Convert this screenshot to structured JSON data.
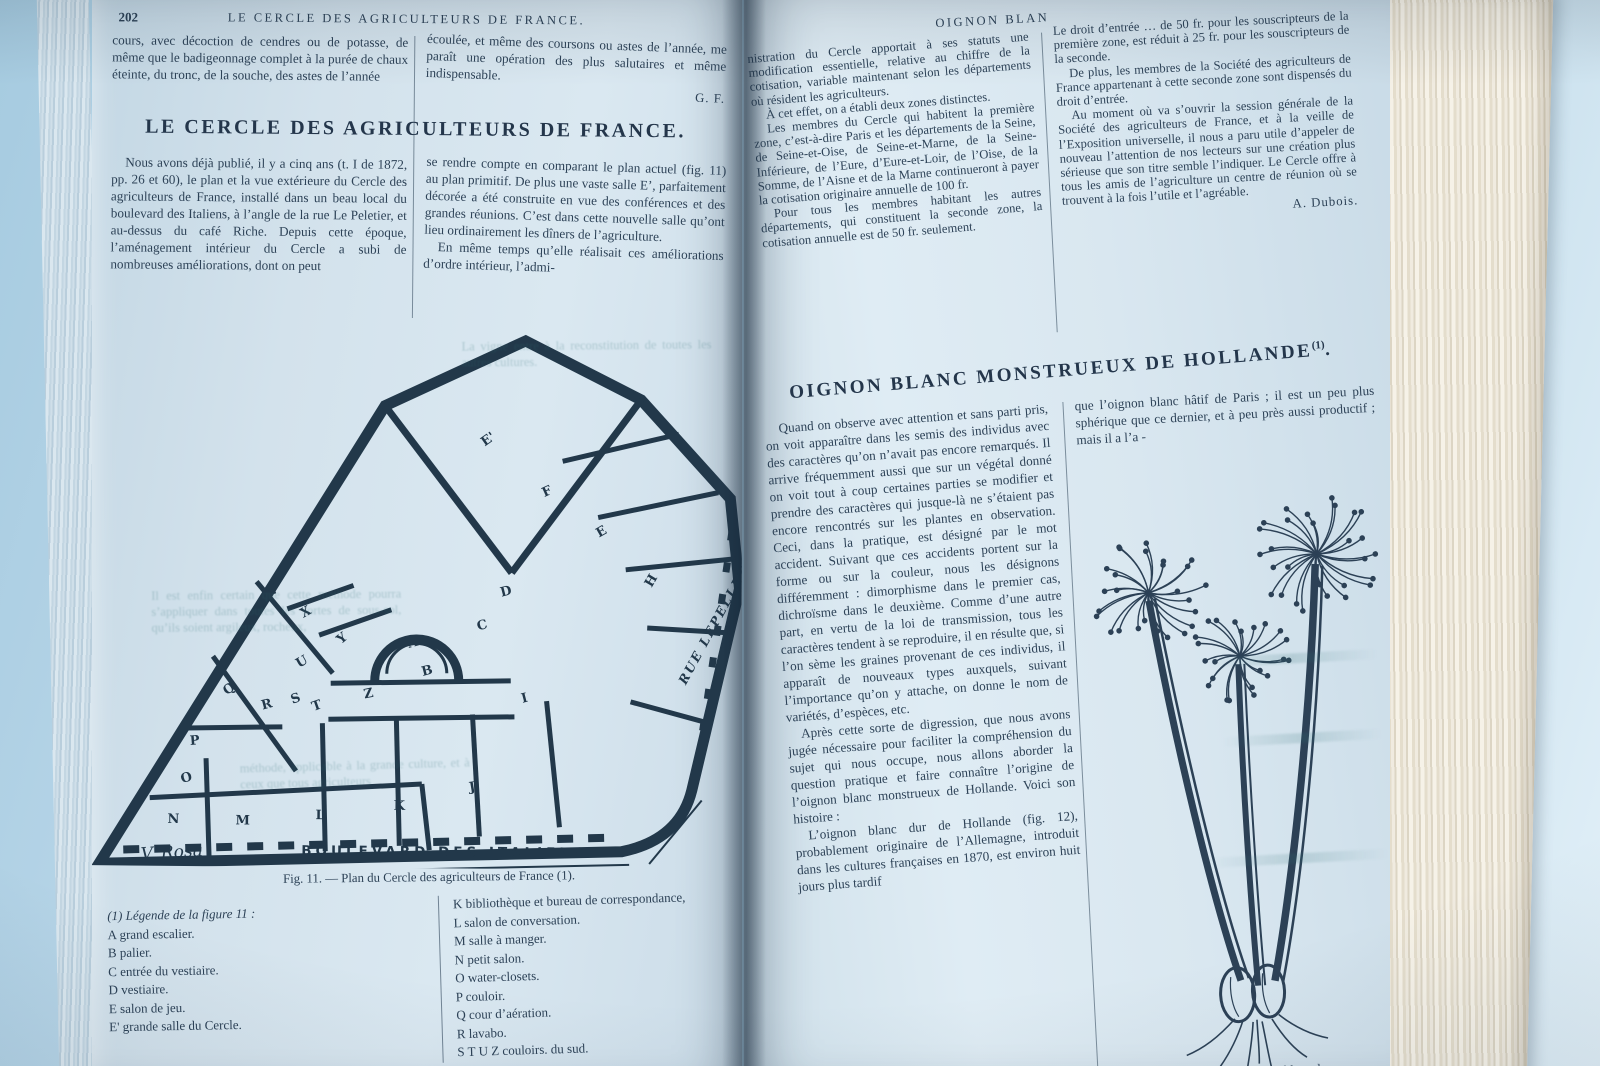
{
  "left_page": {
    "page_number": "202",
    "running_header": "LE CERCLE DES AGRICULTEURS DE FRANCE.",
    "top_col1": "cours, avec décoction de cendres ou de potasse, de même que le badigeonnage complet à la purée de chaux éteinte, du tronc, de la souche, des astes de l’année",
    "top_col2": "écoulée, et même des coursons ou astes de l’année, me paraît une opération des plus salutaires et même indispensable.",
    "top_col2_signature": "G. F.",
    "article_title": "LE CERCLE DES AGRICULTEURS DE FRANCE.",
    "body_col1": "Nous avons déjà publié, il y a cinq ans (t. I de 1872, pp. 26 et 60), le plan et la vue extérieure du Cercle des agriculteurs de France, installé dans un beau local du boulevard des Italiens, à l’angle de la rue Le Peletier, et au-dessus du café Riche. Depuis cette époque, l’aménagement intérieur du Cercle a subi de nombreuses améliorations, dont on peut",
    "body_col2_p1": "se rendre compte en comparant le plan actuel (fig. 11) au plan primitif. De plus une vaste salle E’, parfaitement décorée a été construite en vue des conférences et des grandes réunions. C’est dans cette nouvelle salle qu’ont lieu ordinairement les dîners de l’agriculture.",
    "body_col2_p2": "En même temps qu’elle réalisait ces améliorations d’ordre intérieur, l’admi-",
    "ghost": [
      "La vigne entre à la reconstitution de toutes les autres cultures.",
      "Il est enfin certain que cette méthode pourra s’appliquer dans toutes les sortes de sous-sol, qu’ils soient argileux, rocheux,",
      "méthode, applicable à la grande culture, et à ceux que tous agriculteurs"
    ],
    "figure": {
      "caption": "Fig. 11. — Plan du Cercle des agriculteurs de France (1).",
      "signature": "V. Rosa",
      "street_bottom": "BOULEVARD DES ITALIENS",
      "street_right": "RUE LEPELLETIER",
      "rooms": [
        {
          "t": "E'",
          "x": 392,
          "y": 118,
          "r": -36
        },
        {
          "t": "F",
          "x": 452,
          "y": 168,
          "r": -25
        },
        {
          "t": "E",
          "x": 507,
          "y": 208,
          "r": -30
        },
        {
          "t": "D",
          "x": 410,
          "y": 268,
          "r": -15
        },
        {
          "t": "C",
          "x": 387,
          "y": 302,
          "r": -15
        },
        {
          "t": "A",
          "x": 318,
          "y": 320,
          "r": -15
        },
        {
          "t": "B",
          "x": 332,
          "y": 348,
          "r": -15
        },
        {
          "t": "H",
          "x": 560,
          "y": 258,
          "r": -60
        },
        {
          "t": "I",
          "x": 432,
          "y": 374,
          "r": -15
        },
        {
          "t": "Z",
          "x": 274,
          "y": 371,
          "r": -12
        },
        {
          "t": "Y",
          "x": 250,
          "y": 317,
          "r": -40
        },
        {
          "t": "X",
          "x": 212,
          "y": 291,
          "r": -30
        },
        {
          "t": "V",
          "x": 180,
          "y": 270,
          "r": -40
        },
        {
          "t": "U",
          "x": 208,
          "y": 341,
          "r": -30
        },
        {
          "t": "S",
          "x": 202,
          "y": 377,
          "r": -20
        },
        {
          "t": "T",
          "x": 223,
          "y": 384,
          "r": -20
        },
        {
          "t": "R",
          "x": 172,
          "y": 383,
          "r": -15
        },
        {
          "t": "Q",
          "x": 136,
          "y": 369,
          "r": -35
        },
        {
          "t": "P",
          "x": 100,
          "y": 419,
          "r": -5
        },
        {
          "t": "O",
          "x": 92,
          "y": 457,
          "r": -15
        },
        {
          "t": "N",
          "x": 78,
          "y": 497,
          "r": 0
        },
        {
          "t": "M",
          "x": 146,
          "y": 498,
          "r": 0
        },
        {
          "t": "L",
          "x": 226,
          "y": 492,
          "r": 0
        },
        {
          "t": "K",
          "x": 304,
          "y": 482,
          "r": 0
        },
        {
          "t": "J",
          "x": 380,
          "y": 463,
          "r": -10
        }
      ]
    },
    "legend_left_title": "(1) Légende de la figure 11 :",
    "legend_left": [
      "A  grand escalier.",
      "B  palier.",
      "C  entrée du vestiaire.",
      "D  vestiaire.",
      "E  salon de jeu.",
      "E'  grande salle du Cercle."
    ],
    "legend_right": [
      "K  bibliothèque et bureau de correspondance,",
      "L  salon de conversation.",
      "M  salle à manger.",
      "N  petit salon.",
      "O  water-closets.",
      "P  couloir.",
      "Q  cour d’aération.",
      "R  lavabo.",
      "S T U Z  couloirs.        du sud."
    ]
  },
  "right_page": {
    "running_header": "OIGNON BLAN",
    "top_col1_p1": "nistration du Cercle apportait à ses statuts une modification essentielle, relative au chiffre de la cotisation, variable maintenant selon les départements où résident les agriculteurs.",
    "top_col1_p2": "À cet effet, on a établi deux zones distinctes.",
    "top_col1_p3": "Les membres du Cercle qui habitent la première zone, c’est-à-dire Paris et les départements de la Seine, de Seine-et-Oise, de Seine-et-Marne, de la Seine-Inférieure, de l’Eure, d’Eure-et-Loir, de l’Oise, de la Somme, de l’Aisne et de la Marne continueront à payer la cotisation originaire annuelle de 100 fr.",
    "top_col1_p4": "Pour tous les membres habitant les autres départements, qui constituent la seconde zone, la cotisation annuelle est de 50 fr. seulement.",
    "top_col2_p1": "Le droit d’entrée … de 50 fr. pour les souscripteurs de la première zone, est réduit à 25 fr. pour les souscripteurs de la seconde.",
    "top_col2_p2": "De plus, les membres de la Société des agriculteurs de France appartenant à cette seconde zone sont dispensés du droit d’entrée.",
    "top_col2_p3": "Au moment où va s’ouvrir la session générale de la Société des agriculteurs de France, et à la veille de l’Exposition universelle, il nous a paru utile d’appeler de nouveau l’attention de nos lecteurs sur une création plus sérieuse que son titre semble l’indiquer. Le Cercle offre à tous les amis de l’agriculture un centre de réunion où se trouvent à la fois l’utile et l’agréable.",
    "top_col2_signature": "A. Dubois.",
    "article_title": "OIGNON BLANC MONSTRUEUX DE HOLLANDE",
    "article_title_note": "(1)",
    "body_col1_p1": "Quand on observe avec attention et sans parti pris, on voit apparaître dans les semis des individus avec des caractères qu’on n’avait pas encore remarqués. Il arrive fréquemment aussi que sur un végétal donné on voit tout à coup certaines parties se modifier et prendre des caractères qui jusque-là ne s’étaient pas encore rencontrés sur les plantes en observation. Ceci, dans la pratique, est désigné par le mot accident. Suivant que ces accidents portent sur la forme ou sur la couleur, nous les désignons différemment : dimorphisme dans le premier cas, dichroïsme dans le deuxième. Comme d’une autre part, en vertu de la loi de transmission, tous les caractères tendent à se reproduire, il en résulte que, si l’on sème les graines provenant de ces individus, il apparaît de nouveaux types auxquels, suivant l’importance qu’on y attache, on donne le nom de variétés, d’espèces, etc.",
    "body_col1_p2": "Après cette sorte de digression, que nous avons jugée nécessaire pour faciliter la compréhension du sujet qui nous occupe, nous allons aborder la question pratique et faire connaître l’origine de l’oignon blanc monstrueux de Hollande. Voici son histoire :",
    "body_col1_p3": "L’oignon blanc dur de Hollande (fig. 12), probablement originaire de l’Allemagne, introduit dans les cultures françaises en 1870, est environ huit jours plus tardif",
    "footnote_fragment": "(1) Et…",
    "body_col2_p1": "que l’oignon blanc hâtif de Paris ; il est un peu plus sphérique que ce dernier, et à peu près aussi productif ; mais il a l’a -",
    "fig12_caption_fragment": "Fig. 12. — Oignon blanc d…"
  }
}
